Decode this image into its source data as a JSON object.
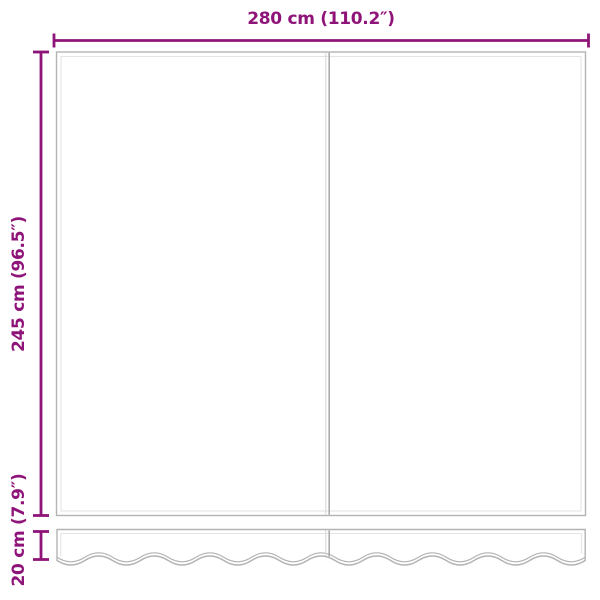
{
  "diagram": {
    "width_dimension_label": "280 cm (110.2″)",
    "height_dimension_label": "245 cm (96.5″)",
    "valance_dimension_label": "20 cm (7.9″)",
    "colors": {
      "accent": "#8f1479",
      "outline": "#b3b3b3",
      "inner": "#e4e4e4",
      "divider_dark": "#a6a6a6",
      "divider_light": "#d9d9d9",
      "background": "#ffffff"
    }
  }
}
